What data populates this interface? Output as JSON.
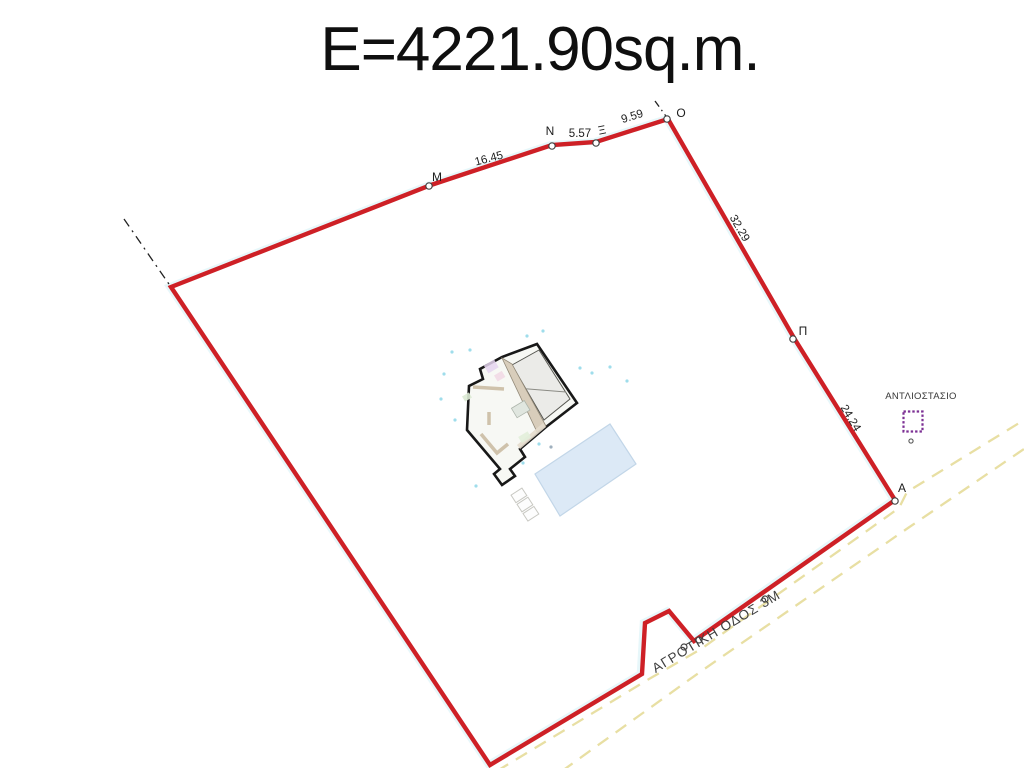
{
  "title": "E=4221.90sq.m.",
  "boundary": {
    "color": "#ce2026",
    "vertex_labels": {
      "m": "M",
      "n": "N",
      "xi": "Ξ",
      "o": "O",
      "pi": "Π",
      "a": "A"
    },
    "edge_lengths": {
      "m_n": "16.45",
      "n_xi": "5.57",
      "xi_o": "9.59",
      "o_pi": "32.29",
      "pi_a": "24.24"
    }
  },
  "road": {
    "label": "ΑΓΡΟΤΙΚΗ ΟΔΟΣ 3Μ",
    "edge_color": "#e8dfa3"
  },
  "pump_station": {
    "label": "ΑΝΤΛΙΟΣΤΑΣΙΟ",
    "outline_color": "#7c3094"
  },
  "pool": {
    "color": "#dce9f6"
  }
}
